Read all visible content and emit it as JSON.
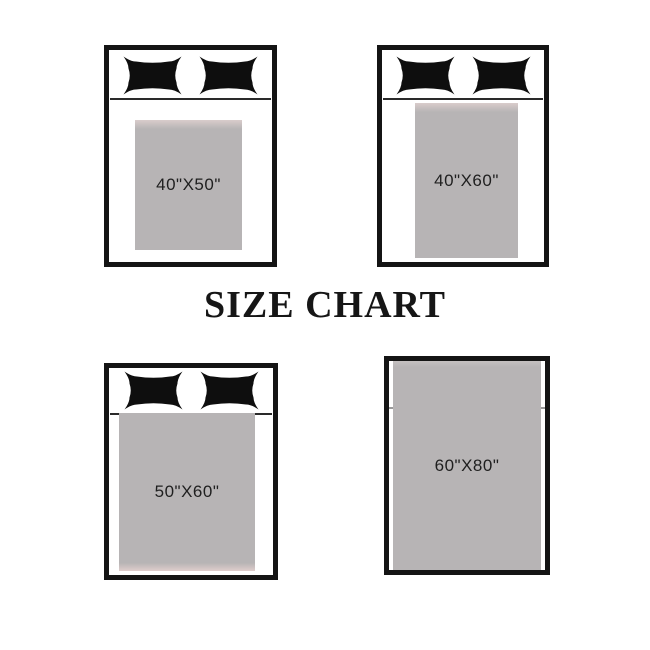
{
  "title": "SIZE CHART",
  "beds": [
    {
      "name": "bed-40x50",
      "label": "40\"X50\"",
      "pillow_count": 2,
      "position": "top-left"
    },
    {
      "name": "bed-40x60",
      "label": "40\"X60\"",
      "pillow_count": 2,
      "position": "top-right"
    },
    {
      "name": "bed-50x60",
      "label": "50\"X60\"",
      "pillow_count": 2,
      "position": "bottom-left"
    },
    {
      "name": "bed-60x80",
      "label": "60\"X80\"",
      "pillow_count": 0,
      "position": "bottom-right"
    }
  ],
  "colors": {
    "background": "#ffffff",
    "bed_frame": "#141414",
    "pillow": "#0e0e0e",
    "blanket": "#b5b3b4",
    "blanket_edge_tint": "#d9cccb",
    "label_text": "#1f1f1f",
    "title_text": "#161616"
  }
}
